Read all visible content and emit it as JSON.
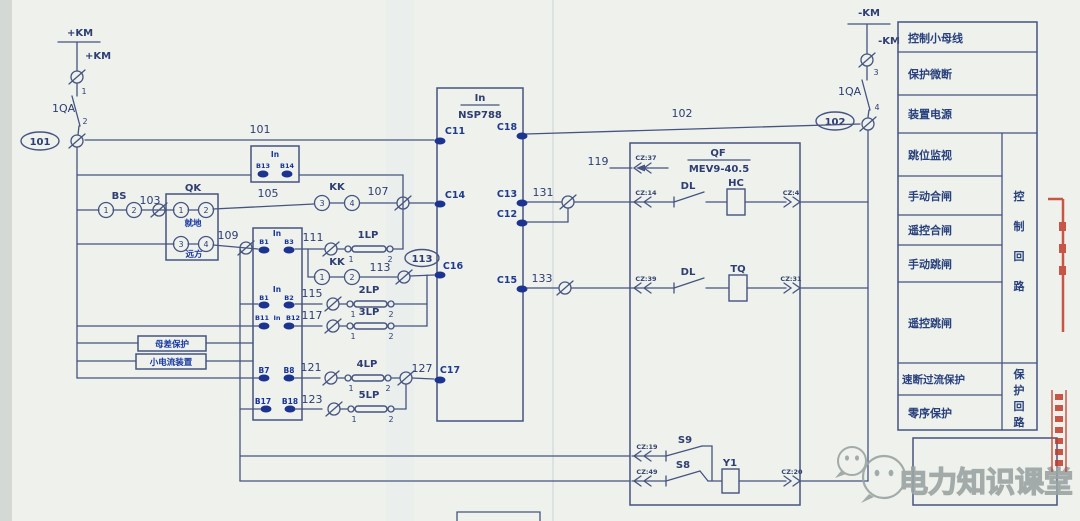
{
  "colors": {
    "ink": "#465481",
    "label_blue": "#16339b",
    "table_text": "#28407c",
    "paper": "#eef1ec",
    "stamp_red": "#c23b2b",
    "watermark_gray": "#9aa4a2"
  },
  "bus_left": {
    "label": "+KM",
    "tap_label": "+KM",
    "pole_top": "1",
    "switch": "1QA",
    "pole_bottom": "2",
    "node": "101"
  },
  "bus_right": {
    "label": "-KM",
    "tap_label": "-KM",
    "pole_top": "3",
    "switch": "1QA",
    "pole_bottom": "4",
    "node": "102"
  },
  "wire_labels": {
    "w101": "101",
    "w102": "102",
    "w103": "103",
    "w105": "105",
    "w107": "107",
    "w109": "109",
    "w111": "111",
    "w113": "113",
    "node_113": "113",
    "w115": "115",
    "w117": "117",
    "w119": "119",
    "w121": "121",
    "w123": "123",
    "w127": "127",
    "w131": "131",
    "w133": "133"
  },
  "ct_aux": {
    "rating": "In",
    "a": "B13",
    "b": "B14"
  },
  "bs_switch": {
    "label": "BS",
    "c1": "1",
    "c2": "2"
  },
  "qk_switch": {
    "label": "QK",
    "c1": "1",
    "c2": "2",
    "c3": "3",
    "c4": "4",
    "mode_local": "就地",
    "mode_remote": "远方"
  },
  "kk_close": {
    "label": "KK",
    "c3": "3",
    "c4": "4"
  },
  "kk_trip": {
    "label": "KK",
    "c1": "1",
    "c2": "2"
  },
  "links": {
    "lp1": {
      "name": "1LP",
      "a": "1",
      "b": "2"
    },
    "lp2": {
      "name": "2LP",
      "a": "1",
      "b": "2"
    },
    "lp3": {
      "name": "3LP",
      "a": "1",
      "b": "2"
    },
    "lp4": {
      "name": "4LP",
      "a": "1",
      "b": "2"
    },
    "lp5": {
      "name": "5LP",
      "a": "1",
      "b": "2"
    }
  },
  "io_groups": {
    "g1": {
      "rating": "In",
      "a": "B1",
      "b": "B3"
    },
    "g2": {
      "rating": "In",
      "a": "B1",
      "b": "B2"
    },
    "g3": {
      "a": "B11",
      "rating": "In",
      "b": "B12"
    },
    "g4": {
      "a": "B7",
      "b": "B8"
    },
    "g5": {
      "a": "B17",
      "b": "B18"
    }
  },
  "side_labels": {
    "bus_protection": "母差保护",
    "small_current": "小电流装置"
  },
  "protection_relay": {
    "rating": "In",
    "model": "NSP788",
    "c11": "C11",
    "c18": "C18",
    "c14": "C14",
    "c13": "C13",
    "c12": "C12",
    "c16": "C16",
    "c15": "C15",
    "c17": "C17"
  },
  "breaker": {
    "name": "QF",
    "model": "MEV9-40.5",
    "cz37": "CZ:37",
    "cz14": "CZ:14",
    "cz4": "CZ:4",
    "cz39": "CZ:39",
    "cz31": "CZ:31",
    "cz19": "CZ:19",
    "cz49": "CZ:49",
    "cz20": "CZ:20",
    "dl_close": "DL",
    "dl_trip": "DL",
    "close_coil": "HC",
    "trip_coil": "TQ",
    "aux_s9": "S9",
    "aux_s8": "S8",
    "aux_coil": "Y1"
  },
  "legend_table": {
    "rows": [
      "控制小母线",
      "保护微断",
      "装置电源",
      "跳位监视",
      "手动合闸",
      "遥控合闸",
      "手动跳闸",
      "遥控跳闸",
      "速断过流保护",
      "零序保护"
    ],
    "group_control": [
      "控",
      "制",
      "回",
      "路"
    ],
    "group_protection": [
      "保",
      "护",
      "回",
      "路"
    ]
  },
  "watermark": {
    "text": "电力知识课堂"
  }
}
